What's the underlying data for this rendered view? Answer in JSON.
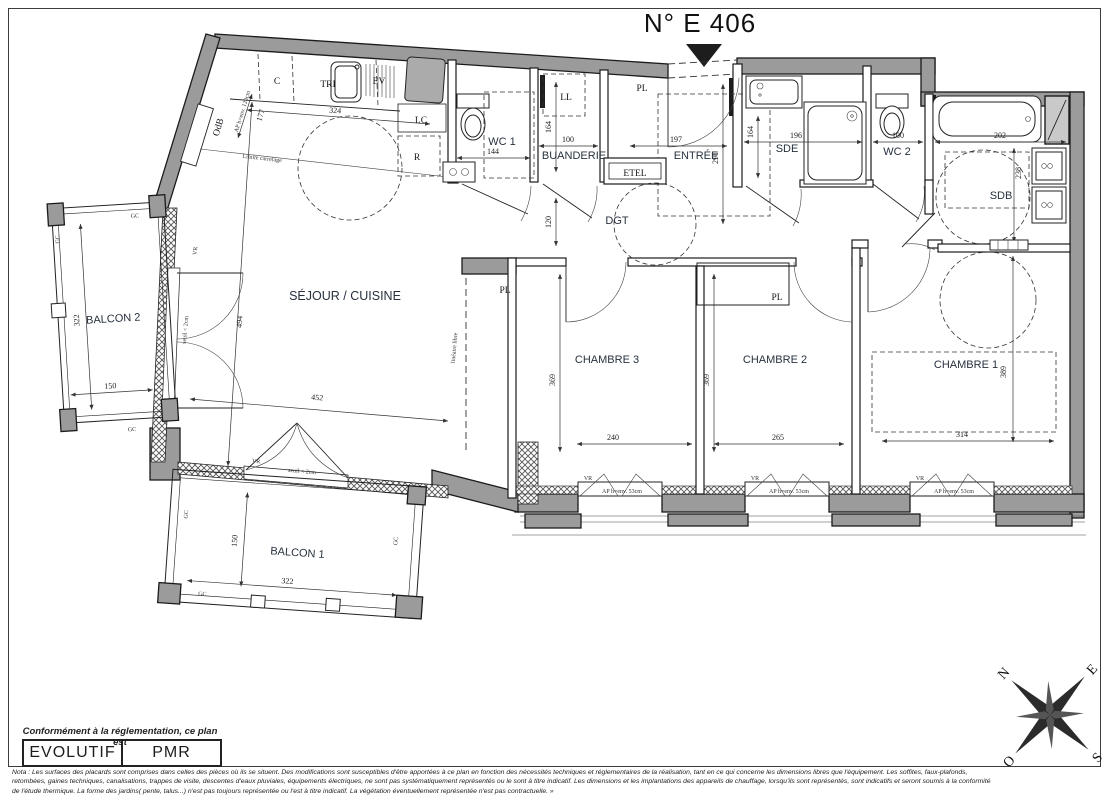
{
  "title": "N° E 406",
  "rooms": {
    "sejour": "SÉJOUR / CUISINE",
    "chambre1": "CHAMBRE 1",
    "chambre2": "CHAMBRE 2",
    "chambre3": "CHAMBRE 3",
    "balcon1": "BALCON 1",
    "balcon2": "BALCON 2",
    "wc1": "WC 1",
    "wc2": "WC 2",
    "sde": "SDE",
    "sdb": "SDB",
    "buanderie": "BUANDERIE",
    "entree": "ENTRÉE",
    "dgt": "DGT"
  },
  "labels": {
    "pl": "PL",
    "ll": "LL",
    "lc": "LC",
    "r": "R",
    "c": "C",
    "tri": "TRI",
    "ev": "EV",
    "etel": "ETEL",
    "odb": "OdB",
    "gc": "GC",
    "vr": "VR",
    "seuil": "seuil < 2cm",
    "ap120": "AP h=env. 120cm",
    "ap53": "AP h=env. 53cm",
    "limite": "Limite carrelage",
    "lineaire": "linéaire libre"
  },
  "dims": {
    "d324": "324",
    "d177": "177",
    "d144": "144",
    "d164": "164",
    "d100": "100",
    "d197": "197",
    "d291": "291",
    "d196": "196",
    "d202": "202",
    "d238": "238",
    "d120": "120",
    "d494": "494",
    "d452": "452",
    "d369": "369",
    "d240": "240",
    "d265": "265",
    "d389": "389",
    "d314": "314",
    "d322": "322",
    "d150": "150"
  },
  "legend": {
    "caption": "Conformément à la réglementation, ce plan est",
    "evolutif": "EVOLUTIF",
    "pmr": "PMR"
  },
  "compass": {
    "n": "N",
    "e": "E",
    "s": "S",
    "o": "O"
  },
  "nota": {
    "line1": "Nota : Les surfaces des placards sont comprises dans celles des pièces où ils se situent. Des modifications sont susceptibles d'être apportées à ce plan en fonction des nécessités techniques et réglementaires de la réalisation, tant en ce qui concerne les dimensions libres que l'équipement.  Les soffites, faux-plafonds,",
    "line2": "retombées, gaines techniques, canalisations, trappes de visite, descentes d'eaux pluviales, équipements électriques, ne sont pas systématiquement représentés ou le sont à titre indicatif. Les dimensions et les implantations des appareils de chauffage, lorsqu'ils sont représentés, sont indicatifs et seront soumis à la conformité",
    "line3": "de l'étude thermique. La forme des jardins( pente, talus...) n'est pas toujours représentée ou l'est à titre indicatif. La végétation éventuellement représentée n'est pas contractuelle. »"
  },
  "colors": {
    "wall": "#9b9b9b",
    "line": "#1d1d1d",
    "room_label": "#27313e"
  }
}
